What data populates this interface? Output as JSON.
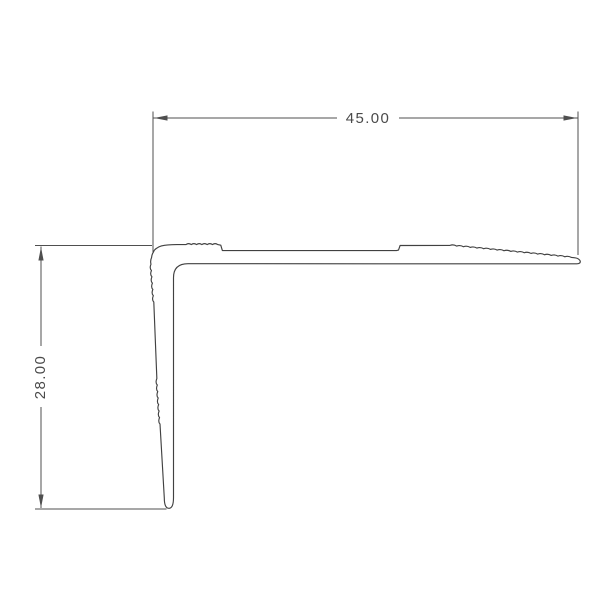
{
  "page": {
    "background_color": "#ffffff"
  },
  "drawing": {
    "kind": "profile-cross-section",
    "line_color": "#4f4f4f",
    "profile_line_color": "#414141",
    "text_color": "#4a4a4a",
    "dimensions": {
      "width": {
        "label": "45.00"
      },
      "height": {
        "label": "28.00"
      }
    }
  }
}
